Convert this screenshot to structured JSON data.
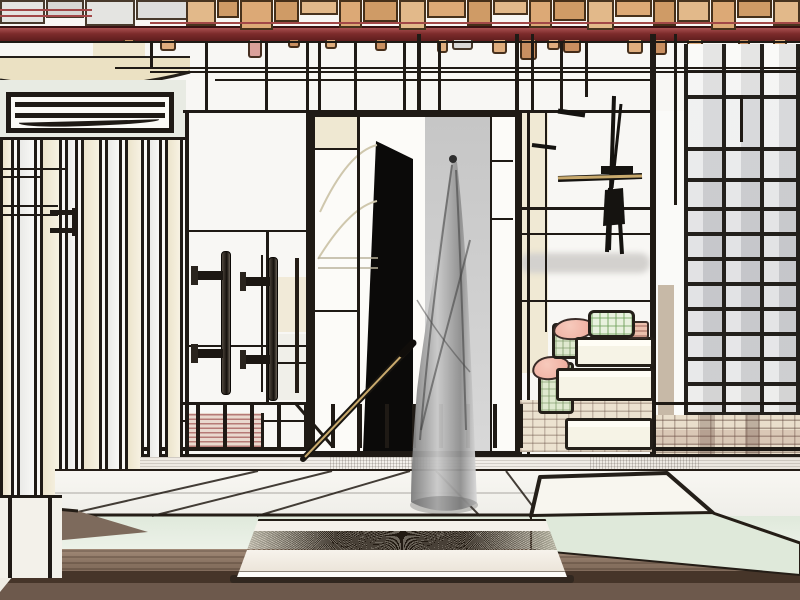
{
  "scene": {
    "type": "illustration",
    "subject": "stylized black-outline drawing of a Japanese-style room interior",
    "elements": [
      "wood-block ceiling",
      "red beam",
      "hanging wood tags",
      "louver vent",
      "vertical blind panels",
      "framed dark doorway with grey hanging drape",
      "leaning pole",
      "wall pull handles",
      "stick stand",
      "shoji grid window",
      "stacked futons with pink cloth and green boxes",
      "plaid textile",
      "railing posts",
      "tatami platform",
      "white low tray",
      "wooden floor"
    ]
  },
  "palette": {
    "paper": "#f8f7f4",
    "ink": "#1f1a15",
    "wa": "#e2b98a",
    "wb": "#cf9b66",
    "wc": "#dca976",
    "beam_hi": "#a84f4f",
    "beam_lo": "#5e1d1d",
    "t0": "#dfae7e",
    "t1": "#c98f60",
    "tp": "#dba09a",
    "tg": "#d9d9d7",
    "cream": "#efe8d2",
    "mint": "#e3ecdd",
    "grey_col": "#c6c6c6",
    "panel_black": "#0b0a09",
    "curtain_dark": "#7d7d7d",
    "curtain_light": "#d9d9d9",
    "floor_mid": "#86705f",
    "floor_dark": "#463529",
    "tray_white": "#f5f1ea",
    "pink": "#f2b4a8",
    "green": "#dfe9cf",
    "pole_tan": "#c8a96d",
    "metal": "#241d16"
  },
  "ceiling": {
    "left_blocks": [
      [
        0,
        45,
        24,
        "#e4e4e1"
      ],
      [
        46,
        38,
        18,
        "#d6d6d3"
      ],
      [
        85,
        50,
        26,
        "#ecethat"
      ],
      [
        136,
        52,
        20,
        "#dddddb"
      ]
    ],
    "wood_blocks": [
      [
        186,
        30,
        26,
        "wa"
      ],
      [
        217,
        22,
        18,
        "wb"
      ],
      [
        240,
        33,
        30,
        "wc"
      ],
      [
        274,
        25,
        22,
        "wb"
      ],
      [
        300,
        38,
        15,
        "wa"
      ],
      [
        339,
        23,
        28,
        "wc"
      ],
      [
        363,
        35,
        22,
        "wb"
      ],
      [
        399,
        27,
        30,
        "wa"
      ],
      [
        427,
        39,
        18,
        "wc"
      ],
      [
        467,
        25,
        26,
        "wb"
      ],
      [
        493,
        35,
        15,
        "wa"
      ],
      [
        529,
        23,
        28,
        "wc"
      ],
      [
        553,
        33,
        21,
        "wb"
      ],
      [
        587,
        27,
        30,
        "wa"
      ],
      [
        615,
        37,
        17,
        "wc"
      ],
      [
        653,
        23,
        26,
        "wb"
      ],
      [
        677,
        33,
        22,
        "wa"
      ],
      [
        711,
        25,
        30,
        "wc"
      ],
      [
        737,
        35,
        18,
        "wb"
      ],
      [
        773,
        27,
        26,
        "wa"
      ]
    ],
    "red_lines": [
      [
        0,
        92,
        9
      ],
      [
        0,
        92,
        15
      ],
      [
        150,
        800,
        22
      ]
    ]
  },
  "tags": [
    [
      123,
      12,
      8,
      "t1"
    ],
    [
      160,
      16,
      11,
      "t0"
    ],
    [
      248,
      14,
      18,
      "tp"
    ],
    [
      288,
      12,
      8,
      "t1"
    ],
    [
      325,
      12,
      9,
      "t0"
    ],
    [
      375,
      12,
      11,
      "t1"
    ],
    [
      437,
      11,
      13,
      "t0"
    ],
    [
      452,
      21,
      10,
      "tg"
    ],
    [
      492,
      15,
      14,
      "t0"
    ],
    [
      520,
      17,
      20,
      "t1"
    ],
    [
      547,
      13,
      10,
      "t0"
    ],
    [
      563,
      18,
      13,
      "t1"
    ],
    [
      627,
      16,
      14,
      "t0"
    ],
    [
      652,
      15,
      15,
      "t1"
    ],
    [
      687,
      16,
      12,
      "t0"
    ],
    [
      738,
      12,
      11,
      "t1"
    ],
    [
      773,
      14,
      16,
      "t0"
    ]
  ],
  "wall": {
    "cells": [
      [
        93,
        42,
        52,
        24,
        "#efe7cf"
      ],
      [
        522,
        111,
        26,
        262,
        "#f0e9d4"
      ],
      [
        266,
        277,
        40,
        55,
        "#f1ead8"
      ],
      [
        266,
        334,
        40,
        66,
        "#f0efe9"
      ],
      [
        656,
        111,
        28,
        304,
        "#fafaf8"
      ],
      [
        658,
        285,
        16,
        130,
        "#c7b9a7"
      ],
      [
        795,
        44,
        5,
        371,
        "#f3f3f1"
      ]
    ],
    "soft_band": [
      520,
      253,
      130,
      20,
      "#d3d1ce"
    ],
    "verticals": [
      [
        150,
        41,
        68,
        3
      ],
      [
        205,
        41,
        111,
        3
      ],
      [
        265,
        41,
        111,
        3
      ],
      [
        306,
        41,
        111,
        3
      ],
      [
        318,
        41,
        111,
        3
      ],
      [
        354,
        41,
        111,
        3
      ],
      [
        403,
        41,
        111,
        3
      ],
      [
        417,
        34,
        111,
        4
      ],
      [
        438,
        41,
        111,
        3
      ],
      [
        515,
        34,
        111,
        4
      ],
      [
        531,
        34,
        111,
        3
      ],
      [
        560,
        41,
        111,
        3
      ],
      [
        585,
        41,
        97,
        3
      ],
      [
        650,
        34,
        474,
        6
      ],
      [
        674,
        34,
        205,
        3
      ],
      [
        740,
        95,
        142,
        3
      ],
      [
        185,
        111,
        474,
        4
      ],
      [
        261,
        255,
        392,
        2
      ],
      [
        266,
        230,
        402,
        3
      ],
      [
        306,
        111,
        460,
        3
      ],
      [
        527,
        111,
        474,
        3
      ],
      [
        545,
        111,
        332,
        2
      ]
    ],
    "horizontals": [
      [
        41,
        0,
        800,
        2
      ],
      [
        67,
        115,
        800,
        2
      ],
      [
        71,
        150,
        800,
        2
      ],
      [
        79,
        215,
        655,
        2
      ],
      [
        110,
        183,
        312,
        3
      ],
      [
        110,
        518,
        656,
        3
      ],
      [
        230,
        185,
        310,
        2
      ],
      [
        345,
        185,
        310,
        2
      ],
      [
        362,
        266,
        310,
        2
      ],
      [
        160,
        490,
        514,
        2
      ],
      [
        218,
        490,
        514,
        2
      ],
      [
        207,
        518,
        656,
        3
      ],
      [
        233,
        518,
        656,
        2
      ],
      [
        300,
        518,
        650,
        2
      ],
      [
        402,
        183,
        800,
        3
      ],
      [
        420,
        183,
        648,
        2
      ],
      [
        447,
        140,
        800,
        4
      ],
      [
        454,
        140,
        800,
        3
      ],
      [
        517,
        225,
        575,
        3
      ]
    ]
  },
  "blinds": {
    "slats": [
      [
        0,
        14,
        "c",
        505
      ],
      [
        17,
        20,
        "w",
        501
      ],
      [
        40,
        22,
        "c",
        497
      ],
      [
        65,
        13,
        "w",
        492
      ],
      [
        81,
        21,
        "c",
        487
      ],
      [
        105,
        17,
        "w",
        481
      ],
      [
        125,
        19,
        "c",
        474
      ],
      [
        147,
        15,
        "w",
        467
      ],
      [
        165,
        18,
        "c",
        459
      ]
    ],
    "lines": [
      [
        137,
        0,
        186,
        3
      ],
      [
        168,
        0,
        68,
        2
      ],
      [
        176,
        0,
        40,
        2
      ],
      [
        205,
        0,
        58,
        2
      ],
      [
        214,
        0,
        58,
        2
      ],
      [
        210,
        50,
        27,
        5
      ],
      [
        228,
        50,
        27,
        5
      ]
    ],
    "bracket_v": [
      72,
      208,
      236,
      5
    ]
  },
  "window": {
    "x": 684,
    "w": 116,
    "top": 44,
    "bottom": 415,
    "cols": [
      684,
      722,
      760,
      796
    ],
    "row_bands": [
      [
        44,
        70,
        "#f7f7f5"
      ],
      [
        70,
        95,
        "#f0f0ef"
      ],
      [
        95,
        147,
        "#e8e9ea"
      ],
      [
        147,
        178,
        "#dfe0e2"
      ],
      [
        178,
        207,
        "#d9dadc"
      ],
      [
        207,
        232,
        "#d5d6d9"
      ],
      [
        232,
        257,
        "#d3d4d7"
      ],
      [
        257,
        282,
        "#d2d3d6"
      ],
      [
        282,
        307,
        "#d3d4d7"
      ],
      [
        307,
        332,
        "#d5d6d8"
      ],
      [
        332,
        357,
        "#d8d9db"
      ],
      [
        357,
        382,
        "#dcddde"
      ],
      [
        382,
        415,
        "#e3e3e2"
      ]
    ],
    "row_lines": [
      70,
      95,
      147,
      178,
      207,
      232,
      257,
      282,
      307,
      332,
      357,
      382,
      412
    ]
  },
  "stack": {
    "parts": [
      [
        "plaidpatch",
        520,
        400,
        132,
        52,
        0
      ],
      [
        "slab",
        565,
        418,
        88,
        32,
        0
      ],
      [
        "green",
        538,
        362,
        36,
        52,
        0
      ],
      [
        "pink",
        532,
        356,
        38,
        24,
        -8
      ],
      [
        "slab",
        556,
        368,
        98,
        33,
        0
      ],
      [
        "green",
        552,
        323,
        27,
        36,
        0
      ],
      [
        "pink",
        553,
        318,
        42,
        22,
        -5
      ],
      [
        "slab",
        575,
        337,
        79,
        30,
        0
      ],
      [
        "pinkstripe",
        627,
        321,
        22,
        18,
        0
      ],
      [
        "pouch",
        588,
        310,
        47,
        28,
        0
      ]
    ]
  },
  "railing": {
    "posts_x": [
      196,
      223,
      250,
      277,
      304,
      331,
      358,
      385,
      412,
      439,
      466,
      493,
      519
    ],
    "post_top": 404,
    "post_bottom": 448,
    "stripe_block": [
      186,
      413,
      78,
      34
    ]
  }
}
